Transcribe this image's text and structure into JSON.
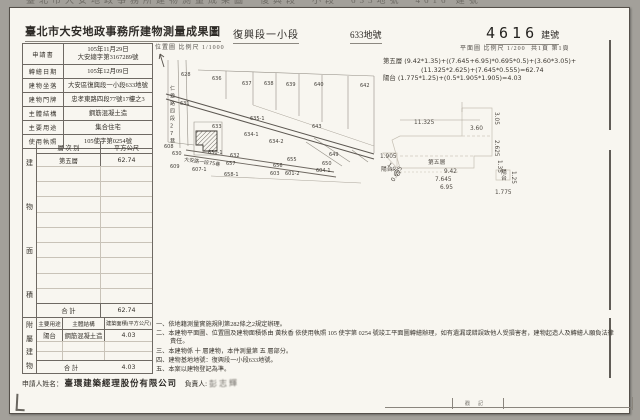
{
  "top_strip": {
    "text": "臺北市大安地政事務所建物測量成果圖　復興段一小段　633地號　4616 建號"
  },
  "header": {
    "title": "臺北市大安地政事務所建物測量成果圖",
    "section": "復興段一小段",
    "parcel": "633地號",
    "building_no": "4616",
    "building_no_unit": "建號",
    "plan_scale": "平面圖 比例尺  1/200",
    "pages": "共1頁 第1頁",
    "map_scale": "位置圖 比例尺  1/1000"
  },
  "info_table": {
    "rows": [
      {
        "label": "申請書",
        "value": "105年11月29日",
        "value2": "大安總字第3167289號"
      },
      {
        "label": "轉繪日期",
        "value": "105年12月09日"
      },
      {
        "label": "建物坐落",
        "value": "大安區復興段一小段633地號"
      },
      {
        "label": "建物門牌",
        "value": "忠孝東路四段77號17樓之3"
      },
      {
        "label": "主體結構",
        "value": "鋼筋混凝土造"
      },
      {
        "label": "主要用途",
        "value": "集合住宅"
      },
      {
        "label": "使用執照",
        "value": "105使字第0254號"
      }
    ]
  },
  "floor_area_table": {
    "side_label": "建物面積",
    "col1": "層 次 別",
    "col2": "平方公尺",
    "rows": [
      {
        "floor": "第五層",
        "area": "62.74"
      }
    ],
    "total_label": "合  計",
    "total": "62.74"
  },
  "annex_table": {
    "side_label": "附屬建物",
    "col1": "主要用途",
    "col2": "主體結構",
    "col3": "建築面積(平方公尺)",
    "rows": [
      {
        "use": "陽台",
        "structure": "鋼筋混凝土造",
        "area": "4.03"
      }
    ],
    "total_label": "合  計",
    "total": "4.03"
  },
  "applicant": {
    "label": "申請人姓名：",
    "name": "臺環建築經理股份有限公司",
    "rep_label": "負責人:",
    "rep_name": "彭志輝"
  },
  "formulas": {
    "line1": "第五層 (9.42*1.35)+((7.645+6.95)*0.695*0.5)+(3.60*3.05)+",
    "line2": "(11.325*2.625)+(7.645*0.555)=62.74",
    "line3": "陽台 (1.775*1.25)+(0.5*1.905*1.905)=4.03"
  },
  "notes": [
    "一、依地籍測量實施規則第282條之2規定辦理。",
    "二、本建物平面圖、位置圖及建物面積係由 黃秋香 依使用執照 105 使字第 0254 號竣工平面圖轉繪辦理，如有遺漏或錯誤致他人受損害者，建物起造人及轉繪人願負法律責任。",
    "三、本建物係 十 層建物，本件測量第 五 層部分。",
    "四、建物基地地號：復興段一小段633地號。",
    "五、本案以建物登記為準。"
  ],
  "location_map": {
    "street_vertical": "仁愛路四段27巷",
    "street_horizontal": "大安路一段75巷",
    "subject_parcel": "633",
    "labels": [
      {
        "t": "628",
        "x": 25,
        "y": 26
      },
      {
        "t": "636",
        "x": 56,
        "y": 30
      },
      {
        "t": "637",
        "x": 86,
        "y": 35
      },
      {
        "t": "638",
        "x": 108,
        "y": 35
      },
      {
        "t": "639",
        "x": 130,
        "y": 36
      },
      {
        "t": "640",
        "x": 158,
        "y": 36
      },
      {
        "t": "642",
        "x": 204,
        "y": 37
      },
      {
        "t": "631",
        "x": 24,
        "y": 55
      },
      {
        "t": "633",
        "x": 56,
        "y": 78,
        "s": 6
      },
      {
        "t": "635-1",
        "x": 94,
        "y": 70
      },
      {
        "t": "634-1",
        "x": 88,
        "y": 86
      },
      {
        "t": "634-2",
        "x": 113,
        "y": 93
      },
      {
        "t": "643",
        "x": 156,
        "y": 78
      },
      {
        "t": "649",
        "x": 173,
        "y": 106
      },
      {
        "t": "650",
        "x": 166,
        "y": 115
      },
      {
        "t": "630",
        "x": 16,
        "y": 105
      },
      {
        "t": "630-1",
        "x": 52,
        "y": 104
      },
      {
        "t": "632",
        "x": 74,
        "y": 107
      },
      {
        "t": "657",
        "x": 70,
        "y": 115
      },
      {
        "t": "658-1",
        "x": 68,
        "y": 126
      },
      {
        "t": "655",
        "x": 131,
        "y": 111
      },
      {
        "t": "656",
        "x": 117,
        "y": 117
      },
      {
        "t": "603",
        "x": 114,
        "y": 125
      },
      {
        "t": "601-2",
        "x": 129,
        "y": 125
      },
      {
        "t": "604-1",
        "x": 160,
        "y": 122
      },
      {
        "t": "608",
        "x": 8,
        "y": 98
      },
      {
        "t": "609",
        "x": 14,
        "y": 118
      },
      {
        "t": "607-1",
        "x": 36,
        "y": 121
      }
    ]
  },
  "floor_plan": {
    "labels": [
      {
        "t": "11.325",
        "x": 36,
        "y": 26
      },
      {
        "t": "3.60",
        "x": 92,
        "y": 32
      },
      {
        "t": "3.05",
        "x": 117,
        "y": 14,
        "r": 90
      },
      {
        "t": "2.625",
        "x": 117,
        "y": 42,
        "r": 90
      },
      {
        "t": "1.35",
        "x": 120,
        "y": 62,
        "r": 90
      },
      {
        "t": "第五層",
        "x": 50,
        "y": 66,
        "s": 7,
        "cjk": true
      },
      {
        "t": "9.42",
        "x": 66,
        "y": 75
      },
      {
        "t": "7.645",
        "x": 57,
        "y": 83
      },
      {
        "t": "6.95",
        "x": 62,
        "y": 91
      },
      {
        "t": "陽台",
        "x": 3,
        "y": 73,
        "s": 5.5,
        "cjk": true
      },
      {
        "t": "1.905",
        "x": 2,
        "y": 60
      },
      {
        "t": "1.905",
        "x": 9,
        "y": 67,
        "r": 45
      },
      {
        "t": "0.695",
        "x": 16,
        "y": 84,
        "r": -60
      },
      {
        "t": "陽",
        "x": 123,
        "y": 76,
        "s": 5,
        "cjk": true
      },
      {
        "t": "台",
        "x": 123,
        "y": 82,
        "s": 5,
        "cjk": true
      },
      {
        "t": "1.775",
        "x": 117,
        "y": 96
      },
      {
        "t": "1.25",
        "x": 134,
        "y": 73,
        "r": 90
      }
    ]
  },
  "stamp_box": {
    "text": "戳記"
  }
}
